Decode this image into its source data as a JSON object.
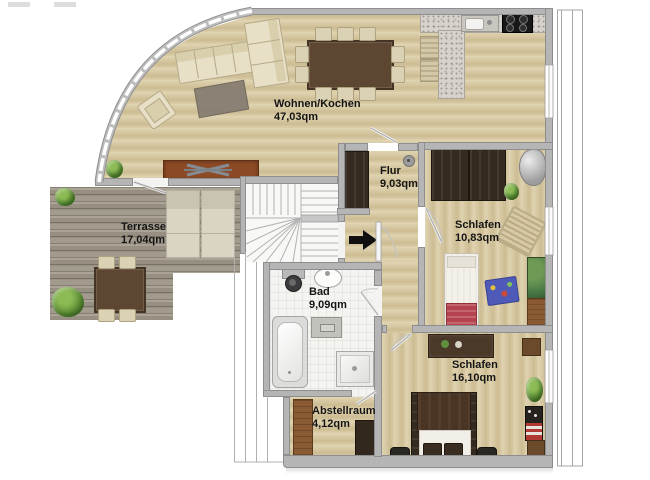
{
  "plan_title": "apartment-floor-plan",
  "rooms": {
    "wohnen_kochen": {
      "name": "Wohnen/Kochen",
      "area": "47,03qm"
    },
    "terrasse": {
      "name": "Terrasse",
      "area": "17,04qm"
    },
    "flur": {
      "name": "Flur",
      "area": "9,03qm"
    },
    "schlafen_klein": {
      "name": "Schlafen",
      "area": "10,83qm"
    },
    "bad": {
      "name": "Bad",
      "area": "9,09qm"
    },
    "schlafen_gross": {
      "name": "Schlafen",
      "area": "16,10qm"
    },
    "abstellraum": {
      "name": "Abstellraum",
      "area": "4,12qm"
    }
  },
  "colors": {
    "wall": "#b5b5b5",
    "wood_floor": "#d8caa6",
    "terrace_deck": "#9e978a",
    "sideboard_accent": "#8c4a26",
    "label_text": "#141414",
    "entrance_arrow": "#0f0f0f"
  }
}
